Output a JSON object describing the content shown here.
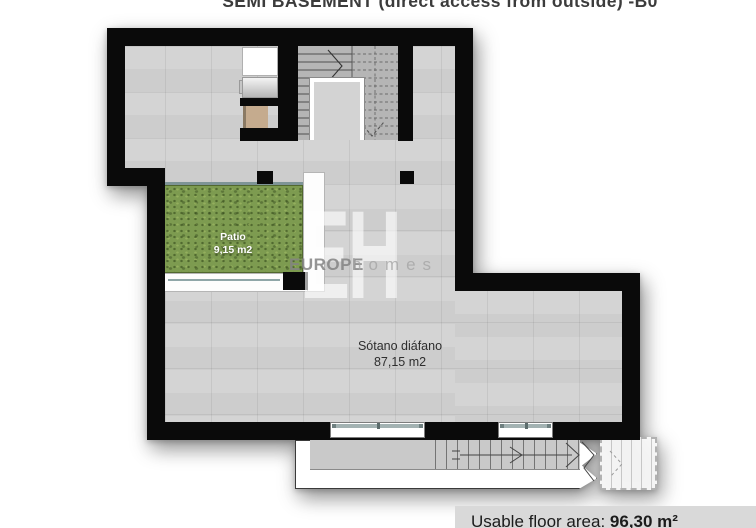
{
  "title": {
    "text": "SEMI BASEMENT (direct access from outside) -B0"
  },
  "watermark": {
    "initials": "EH",
    "brand": "EUROPE",
    "sub": "homes"
  },
  "rooms": {
    "patio": {
      "name": "Patio",
      "area": "9,15 m2"
    },
    "sotano": {
      "name": "Sótano diáfano",
      "area": "87,15 m2"
    }
  },
  "footer": {
    "label": "Usable floor area: ",
    "value": "96,30 m²"
  },
  "colors": {
    "wall": "#0a0a0a",
    "floor_tile": "#d2d2d2",
    "stair_gray": "#b5b5b5",
    "patio_green": "#7d9b50",
    "glass_teal": "#8fa6a8",
    "closet_tan": "#c5ab8e",
    "footer_bg": "#d9d9d9",
    "watermark_gray": "#9a9a9a"
  }
}
